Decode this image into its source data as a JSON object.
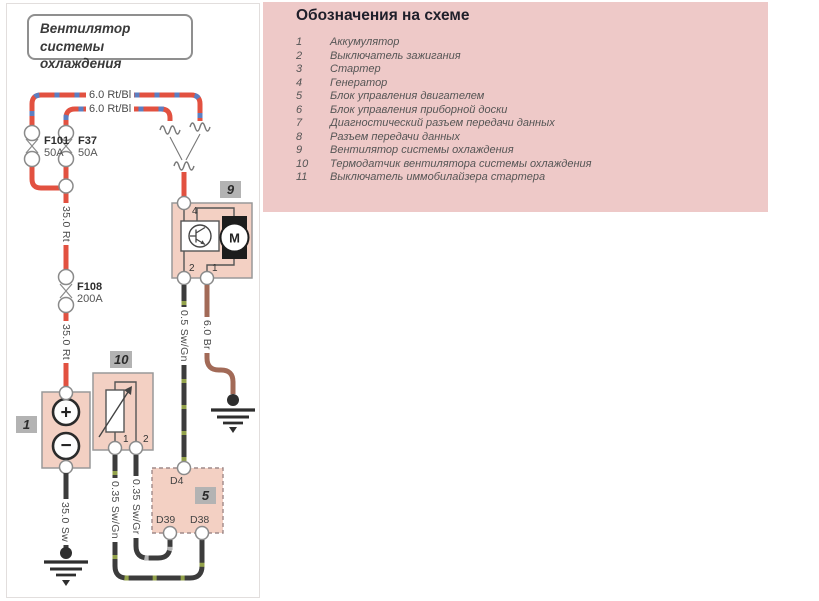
{
  "title_box": {
    "text": "Вентилятор системы охлаждения"
  },
  "legend": {
    "title": "Обозначения на схеме",
    "items": [
      {
        "num": "1",
        "label": "Аккумулятор"
      },
      {
        "num": "2",
        "label": "Выключатель зажигания"
      },
      {
        "num": "3",
        "label": "Стартер"
      },
      {
        "num": "4",
        "label": "Генератор"
      },
      {
        "num": "5",
        "label": "Блок управления двигателем"
      },
      {
        "num": "6",
        "label": "Блок управления приборной доски"
      },
      {
        "num": "7",
        "label": "Диагностический разъем передачи данных"
      },
      {
        "num": "8",
        "label": "Разъем передачи данных"
      },
      {
        "num": "9",
        "label": "Вентилятор системы охлаждения"
      },
      {
        "num": "10",
        "label": "Термодатчик вентилятора системы охлаждения"
      },
      {
        "num": "11",
        "label": "Выключатель иммобилайзера стартера"
      }
    ]
  },
  "wires": {
    "labels": {
      "feed_top": "6.0 Rt/Bl",
      "feed_bottom": "6.0 Rt/Bl",
      "bus_upper": "35.0 Rt",
      "bus_lower": "35.0 Rt",
      "battery_ground": "35.0 Sw",
      "fan_signal": "0.5 Sw/Gn",
      "fan_ground": "6.0 Br",
      "sensor_left": "0.35 Sw/Gn",
      "sensor_right": "0.35 Sw/Gr"
    },
    "colors": {
      "red": "#e25140",
      "blue": "#5c7fc2",
      "brown": "#a26a57",
      "black": "#3c3c3c",
      "green": "#93a24b",
      "gray": "#b5b5b5"
    }
  },
  "fuses": [
    {
      "name": "F101",
      "rating": "50A"
    },
    {
      "name": "F37",
      "rating": "50A"
    },
    {
      "name": "F108",
      "rating": "200A"
    }
  ],
  "components": {
    "battery": {
      "badge": "1",
      "plus": "+",
      "minus": "−"
    },
    "fan_module": {
      "badge": "9",
      "pin4": "4",
      "pin2": "2",
      "pin1": "1",
      "motor": "M"
    },
    "thermo_sensor": {
      "badge": "10",
      "pin1": "1",
      "pin2": "2"
    },
    "engine_ecu": {
      "badge": "5",
      "pin_d4": "D4",
      "pin_d39": "D39",
      "pin_d38": "D38"
    }
  }
}
